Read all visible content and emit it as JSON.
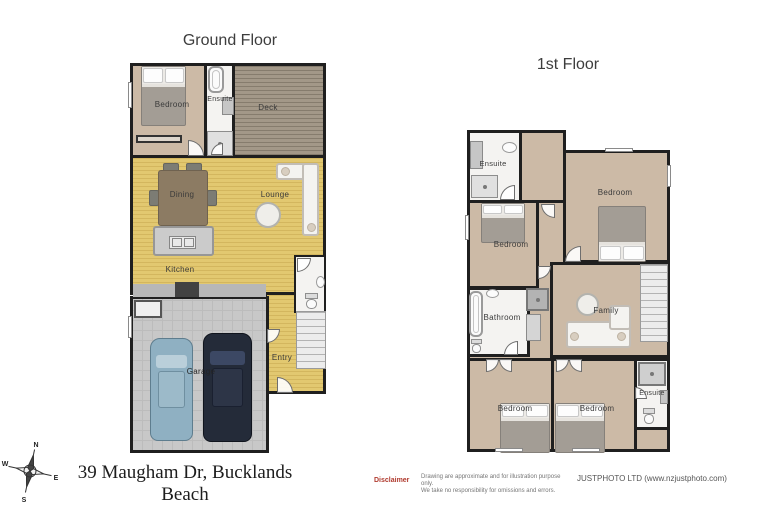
{
  "ground": {
    "title": "Ground Floor",
    "rooms": {
      "bedroom": "Bedroom",
      "ensuite": "Ensuite",
      "deck": "Deck",
      "dining": "Dining",
      "lounge": "Lounge",
      "kitchen": "Kitchen",
      "entry": "Entry",
      "garage": "Garage"
    }
  },
  "first": {
    "title": "1st Floor",
    "rooms": {
      "ensuite_top": "Ensuite",
      "bedroom_top_right": "Bedroom",
      "bedroom_mid_left": "Bedroom",
      "bathroom": "Bathroom",
      "family": "Family",
      "bedroom_bottom_left": "Bedroom",
      "bedroom_bottom_mid": "Bedroom",
      "ensuite_bottom_right": "Ensuite"
    }
  },
  "compass": {
    "north": "N",
    "east": "E",
    "south": "S",
    "west": "W"
  },
  "footer": {
    "address": "39 Maugham Dr, Bucklands Beach",
    "disclaimer_label": "Disclaimer",
    "disclaimer_line1": "Drawing are approximate and for illustration purpose only.",
    "disclaimer_line2": "We take no responsibility for omissions and errors.",
    "company": "JUSTPHOTO LTD (www.nzjustphoto.com)"
  },
  "colors": {
    "wall": "#1f1f1f",
    "wood_floor": "#e2c870",
    "carpet": "#ccbaa6",
    "deck": "#a39888",
    "garage_floor": "#c8c8c8",
    "disclaimer_red": "#b03a2e",
    "car_light": "#8fb0c2",
    "car_dark": "#242b39"
  }
}
